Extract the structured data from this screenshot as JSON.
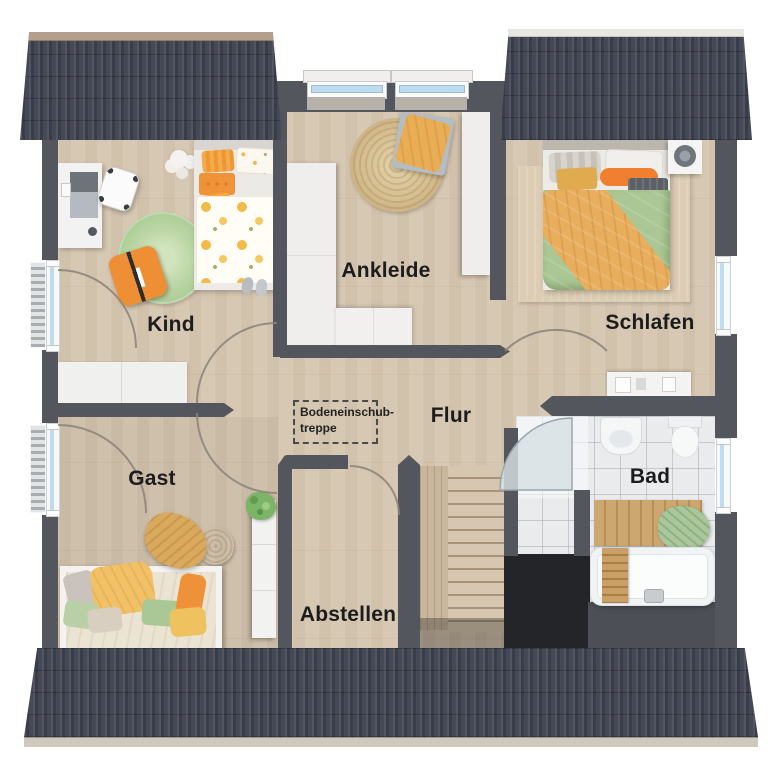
{
  "plan": {
    "room_labels": {
      "kind": "Kind",
      "ankleide": "Ankleide",
      "schlafen": "Schlafen",
      "gast": "Gast",
      "flur": "Flur",
      "bad": "Bad",
      "abstellen": "Abstellen"
    },
    "attic_hatch_label": {
      "line1": "Bodeneinschub-",
      "line2": "treppe"
    },
    "colors": {
      "wall": "#53565c",
      "roof": "#454956",
      "roof_ridge_tan": "#b3a08c",
      "roof_ridge_white": "#e9e7e3",
      "wood_floor": "#d7c8b3",
      "bathroom_tile": "#e9ebec",
      "stairwell_void": "#232528",
      "stair_wood": "#d7c7b0",
      "accent_orange": "#ef9139",
      "accent_green": "#aac896",
      "accent_yellow": "#f2c167",
      "window_glass": "#bfdcee",
      "label_text": "#1c1c1e"
    }
  }
}
